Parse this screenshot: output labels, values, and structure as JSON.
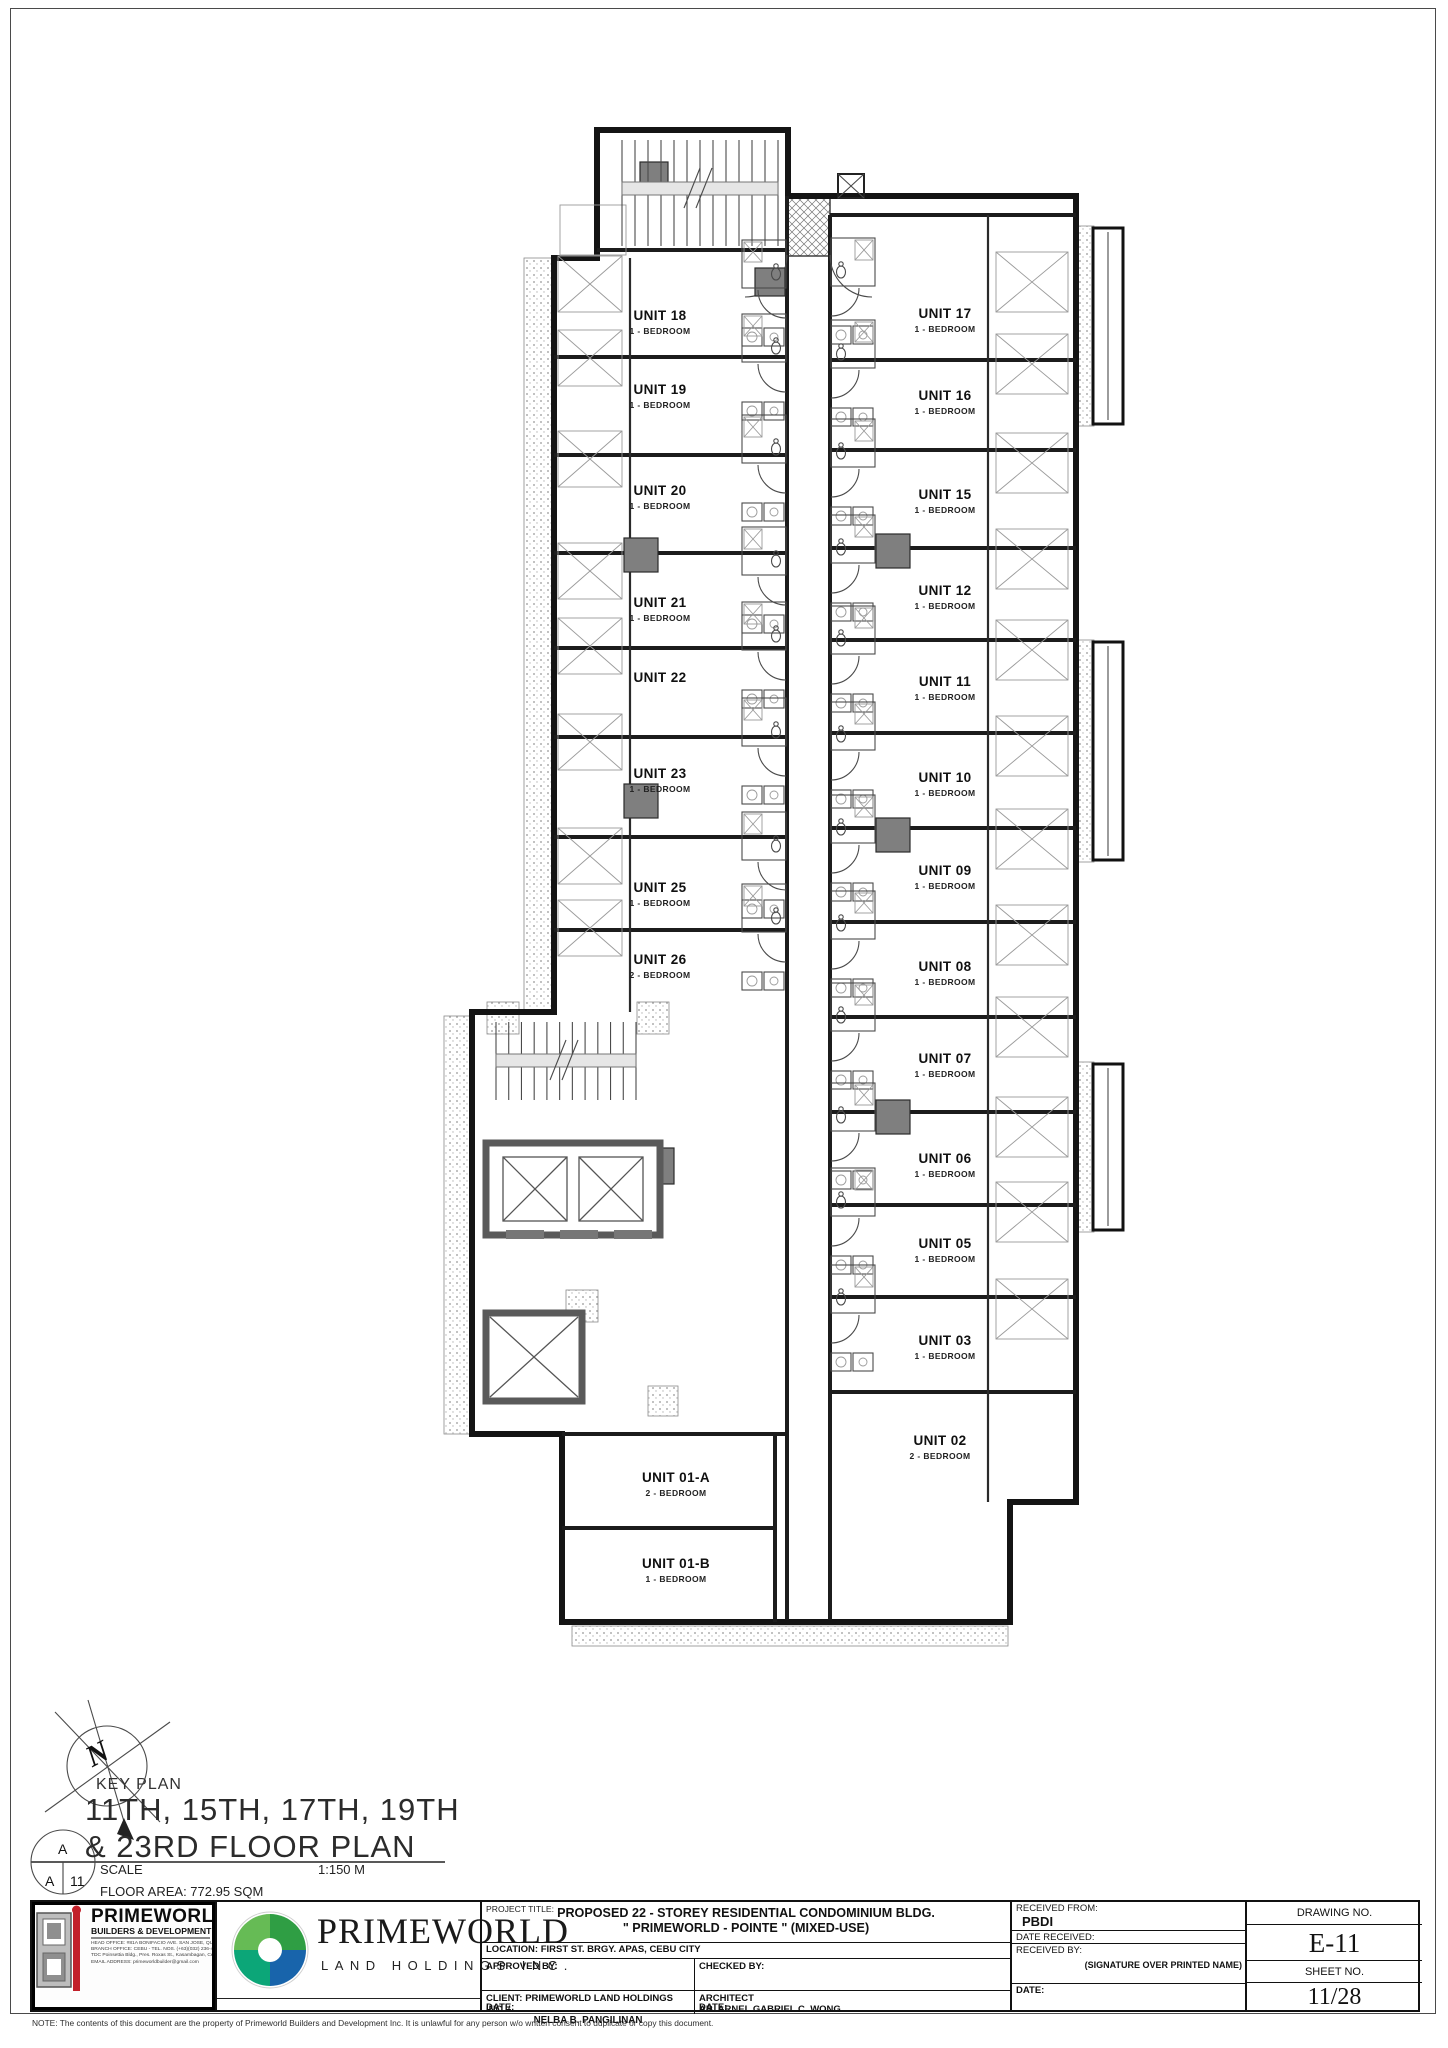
{
  "north": {
    "label": "N"
  },
  "key_plan": {
    "label": "KEY PLAN",
    "floor_title_line1": "11TH, 15TH, 17TH, 19TH",
    "floor_title_line2": "& 23RD FLOOR PLAN",
    "marker_top": "A",
    "marker_bottom_left": "A",
    "marker_bottom_right": "11",
    "scale_label": "SCALE",
    "scale_value": "1:150 M",
    "floor_area": "FLOOR AREA: 772.95 SQM"
  },
  "plan": {
    "units": [
      {
        "name": "UNIT 18",
        "type": "1 - BEDROOM",
        "x": 660,
        "y": 320,
        "side": "left"
      },
      {
        "name": "UNIT 19",
        "type": "1 - BEDROOM",
        "x": 660,
        "y": 394,
        "side": "left"
      },
      {
        "name": "UNIT 20",
        "type": "1 - BEDROOM",
        "x": 660,
        "y": 495,
        "side": "left"
      },
      {
        "name": "UNIT 21",
        "type": "1 - BEDROOM",
        "x": 660,
        "y": 607,
        "side": "left"
      },
      {
        "name": "UNIT 22",
        "x": 660,
        "y": 682,
        "side": "left"
      },
      {
        "name": "UNIT 23",
        "type": "1 - BEDROOM",
        "x": 660,
        "y": 778,
        "side": "left"
      },
      {
        "name": "UNIT 25",
        "type": "1 - BEDROOM",
        "x": 660,
        "y": 892,
        "side": "left"
      },
      {
        "name": "UNIT 26",
        "type": "2 - BEDROOM",
        "x": 660,
        "y": 964,
        "side": "left"
      },
      {
        "name": "UNIT 17",
        "type": "1 - BEDROOM",
        "x": 945,
        "y": 318,
        "side": "right"
      },
      {
        "name": "UNIT 16",
        "type": "1 - BEDROOM",
        "x": 945,
        "y": 400,
        "side": "right"
      },
      {
        "name": "UNIT 15",
        "type": "1 - BEDROOM",
        "x": 945,
        "y": 499,
        "side": "right"
      },
      {
        "name": "UNIT 12",
        "type": "1 - BEDROOM",
        "x": 945,
        "y": 595,
        "side": "right"
      },
      {
        "name": "UNIT 11",
        "type": "1 - BEDROOM",
        "x": 945,
        "y": 686,
        "side": "right"
      },
      {
        "name": "UNIT 10",
        "type": "1 - BEDROOM",
        "x": 945,
        "y": 782,
        "side": "right"
      },
      {
        "name": "UNIT 09",
        "type": "1 - BEDROOM",
        "x": 945,
        "y": 875,
        "side": "right"
      },
      {
        "name": "UNIT 08",
        "type": "1 - BEDROOM",
        "x": 945,
        "y": 971,
        "side": "right"
      },
      {
        "name": "UNIT 07",
        "type": "1 - BEDROOM",
        "x": 945,
        "y": 1063,
        "side": "right"
      },
      {
        "name": "UNIT 06",
        "type": "1 - BEDROOM",
        "x": 945,
        "y": 1163,
        "side": "right"
      },
      {
        "name": "UNIT 05",
        "type": "1 - BEDROOM",
        "x": 945,
        "y": 1248,
        "side": "right"
      },
      {
        "name": "UNIT 03",
        "type": "1 - BEDROOM",
        "x": 945,
        "y": 1345,
        "side": "right"
      },
      {
        "name": "UNIT 02",
        "type": "2 - BEDROOM",
        "x": 940,
        "y": 1445,
        "side": "label"
      },
      {
        "name": "UNIT 01-A",
        "type": "2 - BEDROOM",
        "x": 676,
        "y": 1482,
        "side": "label"
      },
      {
        "name": "UNIT 01-B",
        "type": "1 - BEDROOM",
        "x": 676,
        "y": 1568,
        "side": "label"
      }
    ]
  },
  "title_block": {
    "builders": {
      "name": "PRIMEWORLD",
      "subtitle": "BUILDERS & DEVELOPMENT INC.",
      "address_lines": [
        "HEAD OFFICE: #81A BONIFACIO AVE. SAN JOSE, QUEZON CITY",
        "BRANCH OFFICE: CEBU - TEL. NOS. (+63)(032) 236-4527",
        "TDC Poinsettia Bldg., Pres. Roxas St., Kasambagan, Cebu City, Philippines",
        "EMAIL ADDRESS: primeworldbuilder@gmail.com"
      ]
    },
    "holdings": {
      "name": "PRIMEWORLD",
      "subtitle": "LAND HOLDINGS INC."
    },
    "project": {
      "title_label": "PROJECT TITLE:",
      "title_line1": "PROPOSED 22 - STOREY RESIDENTIAL CONDOMINIUM BLDG.",
      "title_line2": "\" PRIMEWORLD - POINTE \" (MIXED-USE)",
      "location": "LOCATION: FIRST ST. BRGY. APAS, CEBU CITY",
      "approved_by_label": "APPROVED BY:",
      "checked_by_label": "CHECKED BY:",
      "client_label": "CLIENT:",
      "client_name_line1": "PRIMEWORLD LAND HOLDINGS INC. /",
      "client_name_line2": "NELBA B. PANGILINAN",
      "architect_label": "ARCHITECT",
      "architect_name": "AR. ARNEL GABRIEL C. WONG",
      "date_label": "DATE:"
    },
    "received": {
      "received_from_label": "RECEIVED FROM:",
      "received_from_value": "PBDI",
      "date_received_label": "DATE RECEIVED:",
      "received_by_label": "RECEIVED BY:",
      "signature_note": "(SIGNATURE OVER PRINTED NAME)",
      "date_label": "DATE:"
    },
    "drawing": {
      "drawing_no_label": "DRAWING NO.",
      "drawing_no_value": "E-11",
      "sheet_no_label": "SHEET NO.",
      "sheet_no_value": "11/28"
    },
    "note": "NOTE:    The contents of this document are the property of Primeworld Builders and Development Inc. It is unlawful for any person w/o written consent to duplicate or copy this document."
  }
}
